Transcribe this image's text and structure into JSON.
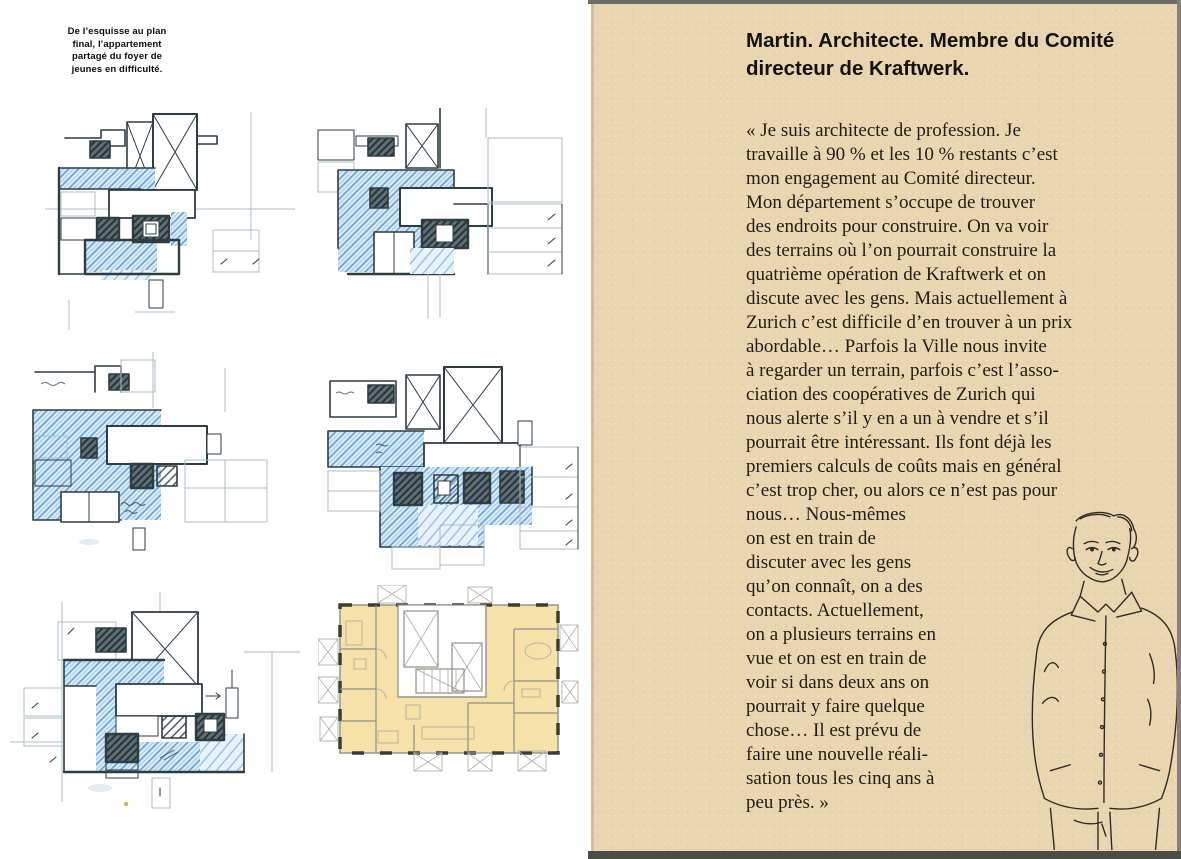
{
  "left_page": {
    "caption_lines": [
      "De l’esquisse au plan",
      "final, l’appartement",
      "partagé du foyer de",
      "jeunes en difficulté."
    ]
  },
  "right_page": {
    "heading_lines": [
      "Martin. Architecte. Membre du Comité",
      "directeur de Kraftwerk."
    ],
    "body_lines": [
      "« Je suis architecte de profession. Je",
      "travaille à 90 % et les 10 % restants c’est",
      "mon engagement au Comité directeur.",
      "Mon département s’occupe de trouver",
      "des endroits pour construire. On va voir",
      "des terrains où l’on pourrait construire la",
      "quatrième opération de Kraftwerk et on",
      "discute avec les gens. Mais actuellement à",
      "Zurich c’est difficile d’en trouver à un prix",
      "abordable… Parfois la Ville nous invite",
      "à regarder un terrain, parfois c’est l’asso-",
      "ciation des coopératives de Zurich qui",
      "nous alerte s’il y en a un à vendre et s’il",
      "pourrait être intéressant. Ils font déjà les",
      "premiers calculs de coûts mais en général",
      "c’est trop cher, ou alors ce n’est pas pour"
    ],
    "body_lines_beside_portrait": [
      "nous… Nous-mêmes",
      "on est en train de",
      "discuter avec les gens",
      "qu’on connaît, on a des",
      "contacts. Actuellement,",
      "on a plusieurs terrains en",
      "vue et on est en train de",
      "voir si dans deux ans on",
      "pourrait y faire quelque",
      "chose… Il est prévu de",
      "faire une nouvelle réali-",
      "sation tous les cinq ans à",
      "peu près. »"
    ]
  },
  "colors": {
    "kraft_paper": "#e9d5b0",
    "ink": "#2e3d40",
    "sketch_blue": "#64a1d8",
    "plan_fill": "#f6e2a9",
    "page_edge_dark": "#4b4b47",
    "body_text": "#211c15"
  }
}
